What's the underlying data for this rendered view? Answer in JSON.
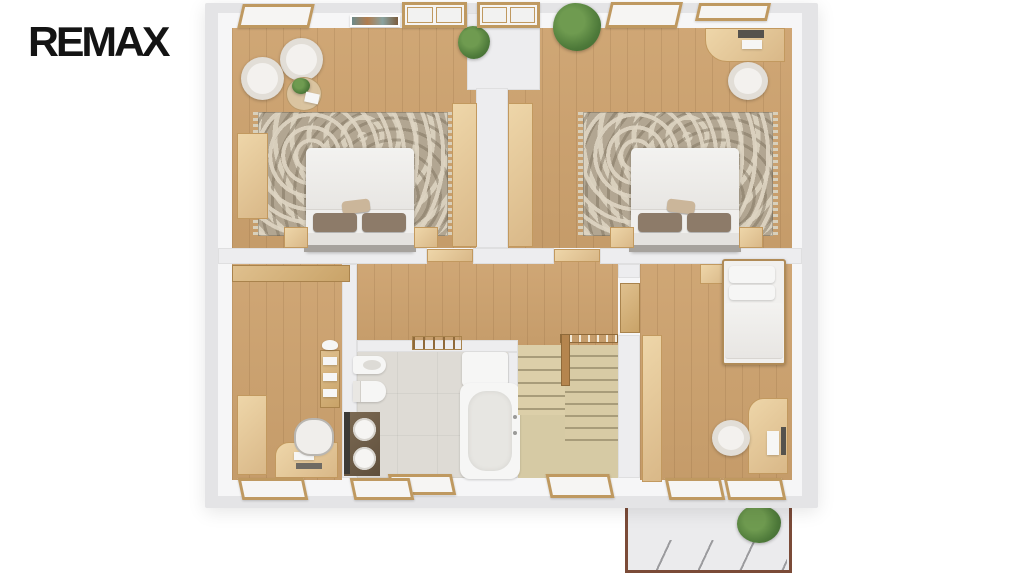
{
  "brand": {
    "logo_text": "REMAX"
  },
  "palette": {
    "background": "#ffffff",
    "logo": "#141414",
    "wall": "#e4e4e6",
    "wall_face": "#f6f6f7",
    "wood_floor": "#cda26e",
    "wood_furniture": "#e3c99c",
    "window_frame_wood": "#bf9960",
    "rug_base": "#b2a692",
    "rug_pattern": "#dcd4c1",
    "bedding_white": "#f0efed",
    "pillow_brown": "#8d7b69",
    "bathroom_tile": "#dedbd5",
    "stairs_wood": "#d6caa4",
    "vanity_dark": "#6f5e4a",
    "balcony_floor": "#ebebed",
    "balcony_rail": "#7b4b38",
    "plant_green": "#4e7a3a"
  },
  "floorplan": {
    "type": "3d-top-down-floor-plan",
    "floor_shown": "upper-floor",
    "rooms": [
      {
        "name": "bedroom-top-left",
        "furniture": [
          "double-bed",
          "floral-rug",
          "wardrobe",
          "tub-armchair",
          "tub-armchair",
          "round-coffee-table",
          "nightstand",
          "nightstand",
          "potted-plant",
          "wall-picture",
          "windows"
        ]
      },
      {
        "name": "bedroom-top-right",
        "furniture": [
          "double-bed",
          "floral-rug",
          "desk-with-laptop",
          "desk-chair",
          "built-in-wardrobe",
          "nightstand",
          "nightstand",
          "large-potted-plant",
          "windows"
        ]
      },
      {
        "name": "room-bottom-left",
        "furniture": [
          "wardrobe",
          "tall-cabinet",
          "desk-with-laptop",
          "office-chair",
          "towel-shelf",
          "window"
        ]
      },
      {
        "name": "bathroom",
        "furniture": [
          "bidet",
          "toilet",
          "double-sink-vanity",
          "bathtub",
          "shower",
          "towel-ladder",
          "window"
        ]
      },
      {
        "name": "staircase",
        "furniture": [
          "wood-stairs",
          "handrail",
          "newel-post"
        ]
      },
      {
        "name": "bedroom-bottom-right",
        "furniture": [
          "single-bed",
          "nightstand",
          "wardrobe",
          "desk-with-laptop",
          "desk-chair",
          "open-door",
          "balcony-doors"
        ]
      },
      {
        "name": "balcony",
        "furniture": [
          "railing",
          "green-bush"
        ]
      }
    ]
  }
}
